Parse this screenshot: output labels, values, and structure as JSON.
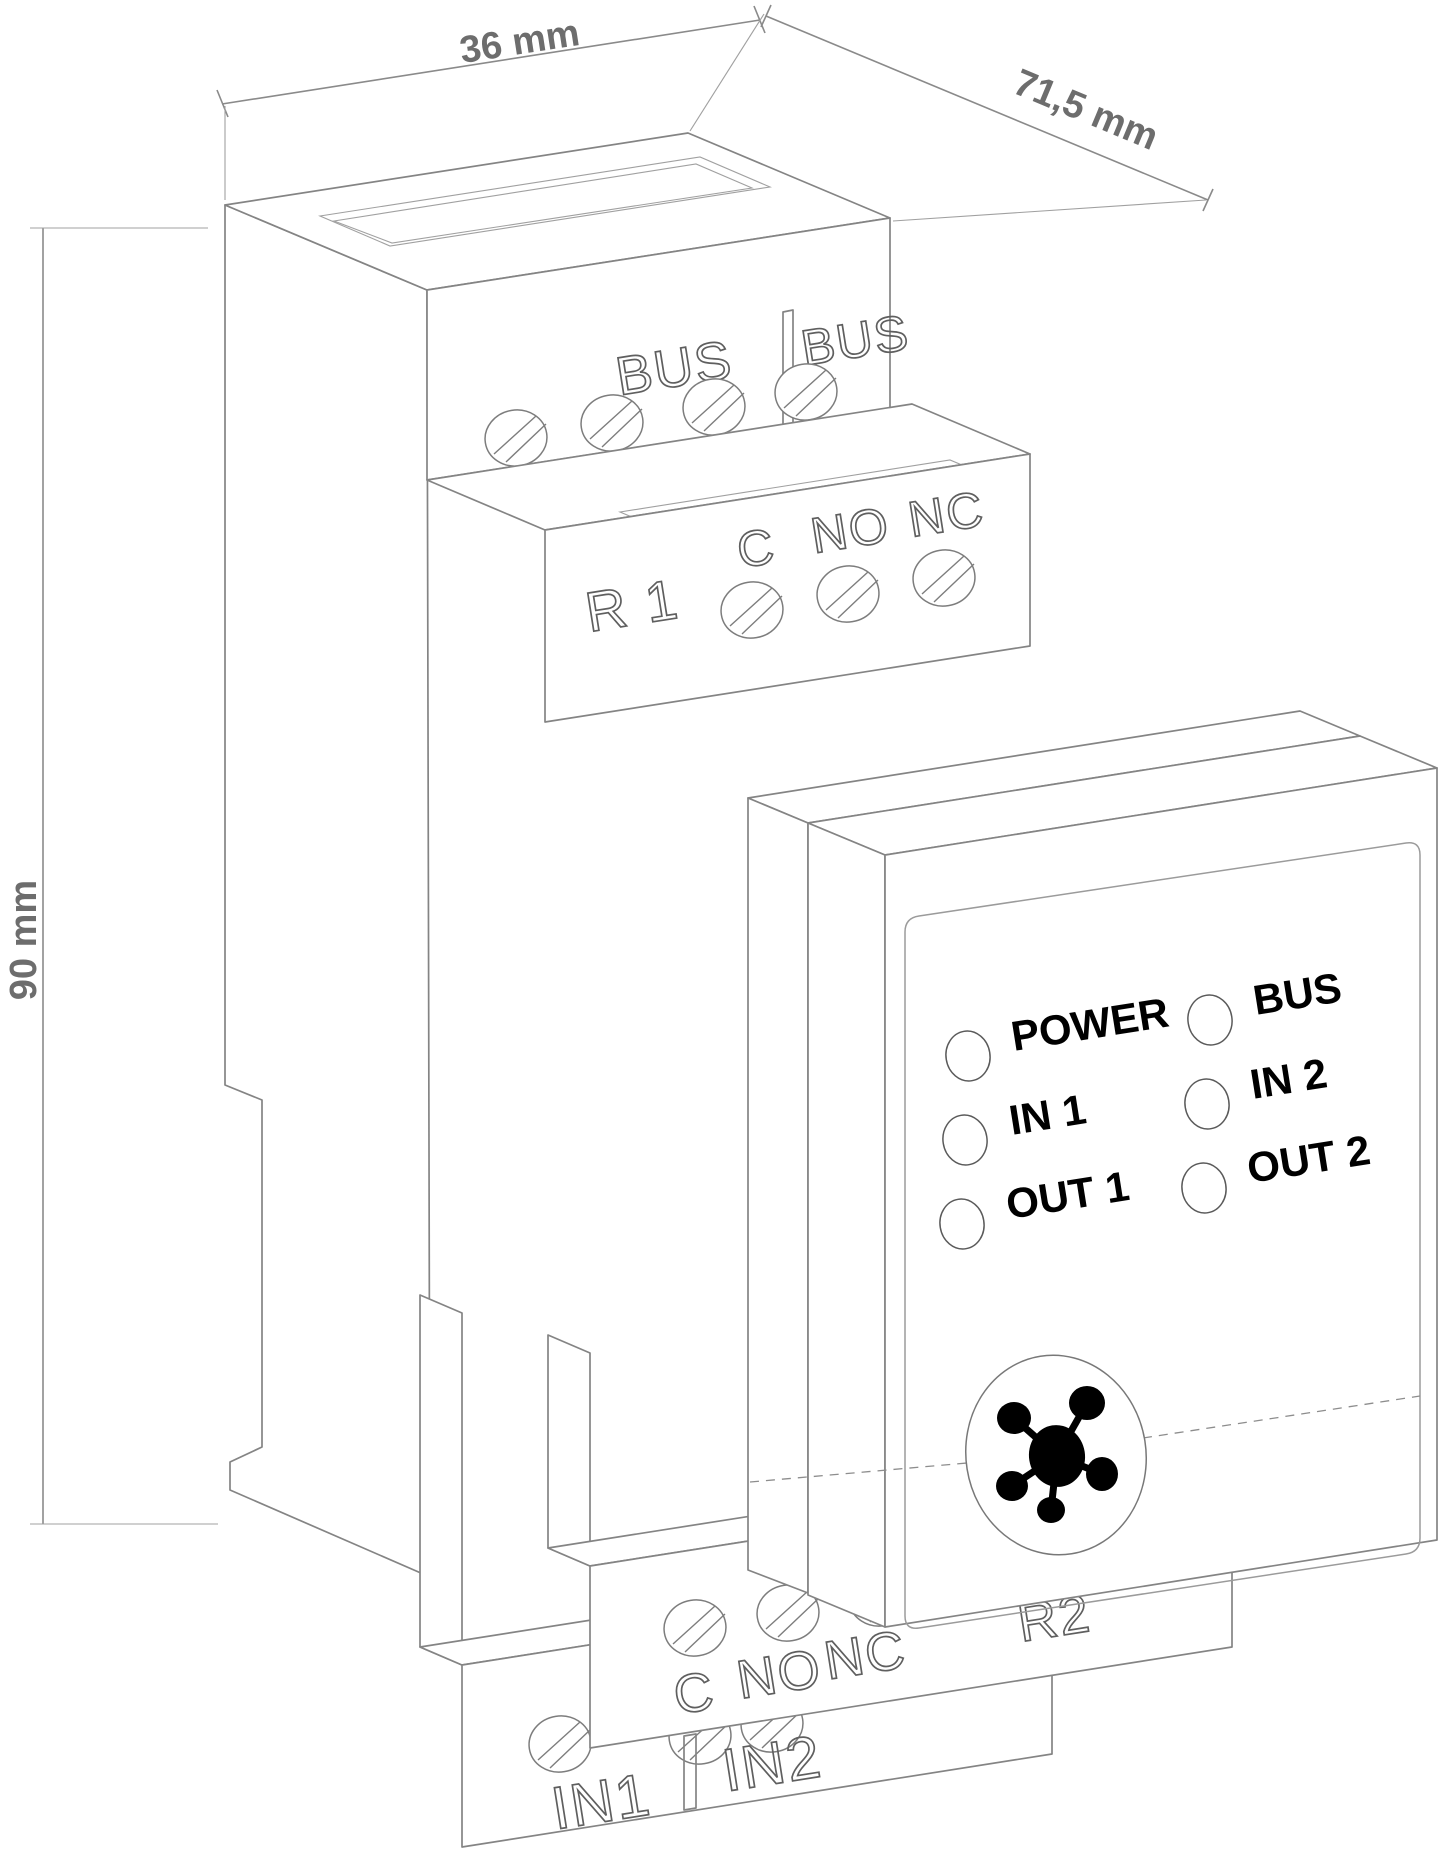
{
  "dimensions": {
    "width": "36 mm",
    "depth": "71,5 mm",
    "height": "90 mm"
  },
  "top_block": {
    "left_label": "BUS",
    "right_label": "BUS"
  },
  "relay1_block": {
    "name": "R 1",
    "contacts": [
      "C",
      "NO",
      "NC"
    ]
  },
  "front_panel": {
    "leds": [
      {
        "label": "POWER"
      },
      {
        "label": "IN 1"
      },
      {
        "label": "OUT 1"
      },
      {
        "label": "BUS"
      },
      {
        "label": "IN 2"
      },
      {
        "label": "OUT 2"
      }
    ]
  },
  "relay2_block": {
    "name": "R2",
    "contacts": [
      "C",
      "NO",
      "NC"
    ]
  },
  "input_block": {
    "left_label": "IN1",
    "right_label": "IN2"
  },
  "colors": {
    "outline": "#848484",
    "emboss_outline": "#5f5f5f",
    "dimension_text": "#6d6d6d",
    "panel_text": "#000000",
    "background": "#ffffff"
  }
}
